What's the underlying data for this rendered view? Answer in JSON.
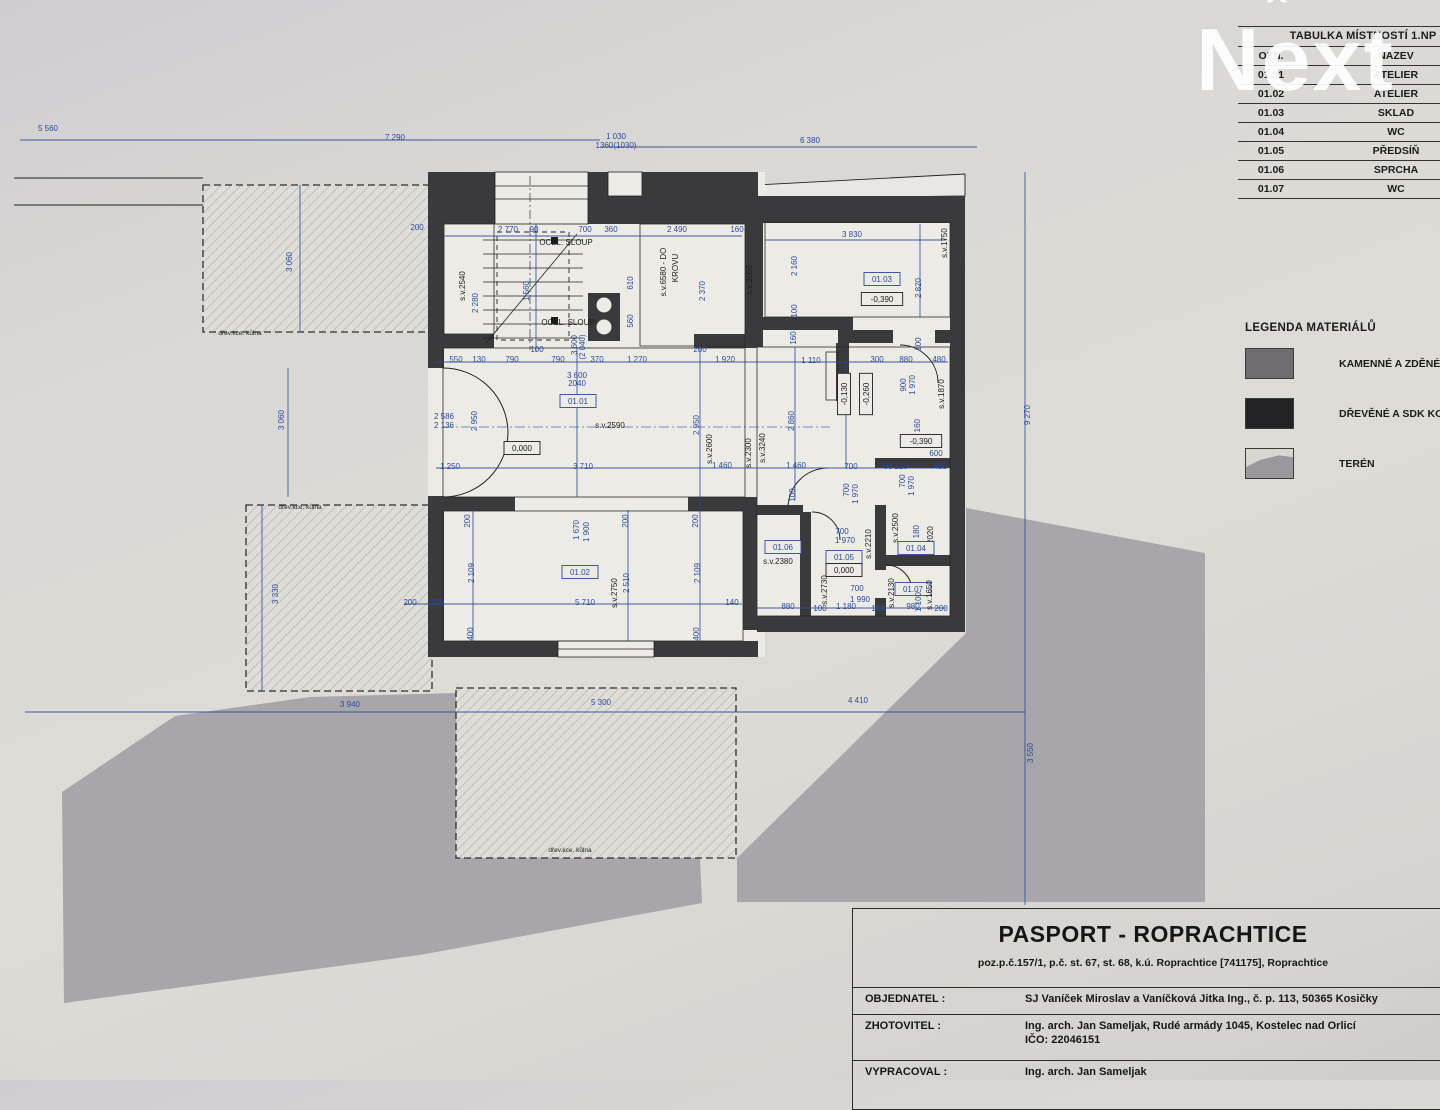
{
  "watermark": {
    "text_n": "N",
    "text_e": "e",
    "caret": "ˆ",
    "text_xt": "xt"
  },
  "colors": {
    "paper": "#dcdad5",
    "terrain_gray": "#a8a6aa",
    "wall_dark": "#3a3a3d",
    "dimension_blue": "#2b4a9b",
    "line_black": "#1f1f1f",
    "watermark_white": "#ffffff"
  },
  "room_table": {
    "title": "TABULKA MÍSTNOSTÍ 1.NP",
    "col_ozn": "OZN.",
    "col_nazev": "NÁZEV",
    "rows": [
      {
        "ozn": "01.01",
        "nazev": "ATELIER"
      },
      {
        "ozn": "01.02",
        "nazev": "ATELIER"
      },
      {
        "ozn": "01.03",
        "nazev": "SKLAD"
      },
      {
        "ozn": "01.04",
        "nazev": "WC"
      },
      {
        "ozn": "01.05",
        "nazev": "PŘEDSÍŇ"
      },
      {
        "ozn": "01.06",
        "nazev": "SPRCHA"
      },
      {
        "ozn": "01.07",
        "nazev": "WC"
      }
    ]
  },
  "legend": {
    "title": "LEGENDA MATERIÁLŮ",
    "items": [
      {
        "label": "KAMENNÉ A ZDĚNÉ K",
        "swatch": "masonry"
      },
      {
        "label": "DŘEVĚNÉ A SDK KO",
        "swatch": "wood"
      },
      {
        "label": "TERÉN",
        "swatch": "terrain"
      }
    ]
  },
  "title_block": {
    "title": "PASPORT - ROPRACHTICE",
    "subtitle": "poz.p.č.157/1, p.č. st. 67, st. 68, k.ú. Roprachtice [741175], Roprachtice",
    "fields": [
      {
        "label": "OBJEDNATEL :",
        "value": "SJ Vaníček Miroslav a Vaníčková Jitka Ing., č. p. 113, 50365 Kosičky",
        "value2": ""
      },
      {
        "label": "ZHOTOVITEL :",
        "value": "Ing. arch. Jan Sameljak, Rudé armády 1045, Kostelec nad Orlicí",
        "value2": "IČO: 22046151"
      },
      {
        "label": "VYPRACOVAL :",
        "value": "Ing. arch. Jan Sameljak",
        "value2": ""
      }
    ]
  },
  "plan": {
    "labels": [
      {
        "t": "5 560",
        "x": 48,
        "y": 131
      },
      {
        "t": "7 290",
        "x": 395,
        "y": 140
      },
      {
        "t": "1 030",
        "x": 616,
        "y": 139
      },
      {
        "t": "1360(1030)",
        "x": 616,
        "y": 148
      },
      {
        "t": "6 380",
        "x": 810,
        "y": 143
      },
      {
        "t": "9 270",
        "x": 1030,
        "y": 415,
        "r": -90
      },
      {
        "t": "3 550",
        "x": 1033,
        "y": 753,
        "r": -90
      },
      {
        "t": "3 940",
        "x": 350,
        "y": 707
      },
      {
        "t": "5 300",
        "x": 601,
        "y": 705
      },
      {
        "t": "4 410",
        "x": 858,
        "y": 703
      },
      {
        "t": "3 060",
        "x": 292,
        "y": 262,
        "r": -90
      },
      {
        "t": "3 060",
        "x": 284,
        "y": 420,
        "r": -90
      },
      {
        "t": "3 330",
        "x": 278,
        "y": 594,
        "r": -90
      },
      {
        "t": "200",
        "x": 417,
        "y": 230
      },
      {
        "t": "2 770",
        "x": 508,
        "y": 232
      },
      {
        "t": "90",
        "x": 534,
        "y": 232
      },
      {
        "t": "700",
        "x": 585,
        "y": 232
      },
      {
        "t": "360",
        "x": 611,
        "y": 232
      },
      {
        "t": "2 490",
        "x": 677,
        "y": 232
      },
      {
        "t": "160",
        "x": 737,
        "y": 232
      },
      {
        "t": "3 830",
        "x": 852,
        "y": 237
      },
      {
        "t": "s.v.1750",
        "x": 947,
        "y": 243,
        "r": -90,
        "c": "k"
      },
      {
        "t": "s.v.2540",
        "x": 465,
        "y": 286,
        "r": -90,
        "c": "k"
      },
      {
        "t": "2 280",
        "x": 478,
        "y": 303,
        "r": -90
      },
      {
        "t": "1 560",
        "x": 529,
        "y": 291,
        "r": -90
      },
      {
        "t": "610",
        "x": 633,
        "y": 283,
        "r": -90
      },
      {
        "t": "560",
        "x": 633,
        "y": 321,
        "r": -90
      },
      {
        "t": "s.v.6580 - DO",
        "x": 666,
        "y": 272,
        "r": -90,
        "c": "k"
      },
      {
        "t": "KROVU",
        "x": 678,
        "y": 268,
        "r": -90,
        "c": "k"
      },
      {
        "t": "2 370",
        "x": 705,
        "y": 291,
        "r": -90
      },
      {
        "t": "s.v.3060",
        "x": 752,
        "y": 280,
        "r": -90,
        "c": "k"
      },
      {
        "t": "2 160",
        "x": 797,
        "y": 266,
        "r": -90
      },
      {
        "t": "01.03",
        "x": 882,
        "y": 282,
        "bx": 1
      },
      {
        "t": "-0,390",
        "x": 882,
        "y": 302,
        "bx": 1,
        "c": "k"
      },
      {
        "t": "2 820",
        "x": 921,
        "y": 288,
        "r": -90
      },
      {
        "t": "100",
        "x": 797,
        "y": 311,
        "r": -90
      },
      {
        "t": "100",
        "x": 921,
        "y": 344,
        "r": -90
      },
      {
        "t": "OCEL. SLOUP",
        "x": 566,
        "y": 245,
        "c": "k"
      },
      {
        "t": "OCEL. SLOUP",
        "x": 568,
        "y": 325,
        "c": "k"
      },
      {
        "t": "100",
        "x": 537,
        "y": 352
      },
      {
        "t": "3 600",
        "x": 577,
        "y": 345,
        "r": -90
      },
      {
        "t": "(2 040)",
        "x": 585,
        "y": 347,
        "r": -90
      },
      {
        "t": "550",
        "x": 456,
        "y": 362
      },
      {
        "t": "130",
        "x": 479,
        "y": 362
      },
      {
        "t": "790",
        "x": 512,
        "y": 362
      },
      {
        "t": "790",
        "x": 558,
        "y": 362
      },
      {
        "t": "370",
        "x": 597,
        "y": 362
      },
      {
        "t": "1 270",
        "x": 637,
        "y": 362
      },
      {
        "t": "1 920",
        "x": 725,
        "y": 362
      },
      {
        "t": "1 110",
        "x": 811,
        "y": 363
      },
      {
        "t": "300",
        "x": 877,
        "y": 362
      },
      {
        "t": "880",
        "x": 906,
        "y": 362
      },
      {
        "t": "480",
        "x": 939,
        "y": 362
      },
      {
        "t": "200",
        "x": 700,
        "y": 352
      },
      {
        "t": "160",
        "x": 796,
        "y": 338,
        "r": -90
      },
      {
        "t": "3 600",
        "x": 577,
        "y": 378
      },
      {
        "t": "2040",
        "x": 577,
        "y": 386
      },
      {
        "t": "900",
        "x": 906,
        "y": 385,
        "r": -90
      },
      {
        "t": "1 970",
        "x": 915,
        "y": 385,
        "r": -90
      },
      {
        "t": "s.v.1870",
        "x": 944,
        "y": 394,
        "r": -90,
        "c": "k"
      },
      {
        "t": "-0,130",
        "x": 847,
        "y": 394,
        "r": -90,
        "bx": 1,
        "c": "k"
      },
      {
        "t": "-0,260",
        "x": 869,
        "y": 394,
        "r": -90,
        "bx": 1,
        "c": "k"
      },
      {
        "t": "01.01",
        "x": 578,
        "y": 404,
        "bx": 1
      },
      {
        "t": "s.v.2590",
        "x": 610,
        "y": 428,
        "c": "k"
      },
      {
        "t": "0,000",
        "x": 522,
        "y": 451,
        "bx": 1,
        "c": "k"
      },
      {
        "t": "2 586",
        "x": 444,
        "y": 419
      },
      {
        "t": "2 136",
        "x": 444,
        "y": 428
      },
      {
        "t": "2 950",
        "x": 477,
        "y": 421,
        "r": -90
      },
      {
        "t": "2 950",
        "x": 699,
        "y": 425,
        "r": -90
      },
      {
        "t": "2 860",
        "x": 794,
        "y": 421,
        "r": -90
      },
      {
        "t": "s.v.2600",
        "x": 712,
        "y": 449,
        "r": -90,
        "c": "k"
      },
      {
        "t": "s.v.2300",
        "x": 751,
        "y": 453,
        "r": -90,
        "c": "k"
      },
      {
        "t": "s.v.3240",
        "x": 765,
        "y": 448,
        "r": -90,
        "c": "k"
      },
      {
        "t": "2 160",
        "x": 920,
        "y": 429,
        "r": -90
      },
      {
        "t": "-0,390",
        "x": 921,
        "y": 444,
        "bx": 1,
        "c": "k"
      },
      {
        "t": "600",
        "x": 936,
        "y": 456
      },
      {
        "t": "1 250",
        "x": 450,
        "y": 469
      },
      {
        "t": "3 710",
        "x": 583,
        "y": 469
      },
      {
        "t": "1 460",
        "x": 722,
        "y": 468
      },
      {
        "t": "1 460",
        "x": 796,
        "y": 468
      },
      {
        "t": "700",
        "x": 851,
        "y": 469
      },
      {
        "t": "90",
        "x": 888,
        "y": 469
      },
      {
        "t": "210",
        "x": 901,
        "y": 469
      },
      {
        "t": "480",
        "x": 940,
        "y": 469
      },
      {
        "t": "700",
        "x": 905,
        "y": 481,
        "r": -90
      },
      {
        "t": "1 970",
        "x": 914,
        "y": 486,
        "r": -90
      },
      {
        "t": "100",
        "x": 795,
        "y": 495,
        "r": -90
      },
      {
        "t": "700",
        "x": 849,
        "y": 490,
        "r": -90
      },
      {
        "t": "1 970",
        "x": 858,
        "y": 494,
        "r": -90
      },
      {
        "t": "01.06",
        "x": 783,
        "y": 550,
        "bx": 1
      },
      {
        "t": "s.v.2380",
        "x": 778,
        "y": 564,
        "c": "k"
      },
      {
        "t": "700",
        "x": 842,
        "y": 534
      },
      {
        "t": "1 970",
        "x": 845,
        "y": 543
      },
      {
        "t": "01.05",
        "x": 844,
        "y": 560,
        "bx": 1
      },
      {
        "t": "0,000",
        "x": 844,
        "y": 573,
        "bx": 1,
        "c": "k"
      },
      {
        "t": "s.v.2210",
        "x": 871,
        "y": 544,
        "r": -90,
        "c": "k"
      },
      {
        "t": "s.v.2500",
        "x": 898,
        "y": 528,
        "r": -90,
        "c": "k"
      },
      {
        "t": "1 180",
        "x": 919,
        "y": 535,
        "r": -90
      },
      {
        "t": "s.v.2020",
        "x": 933,
        "y": 541,
        "r": -90,
        "c": "k"
      },
      {
        "t": "01.04",
        "x": 916,
        "y": 551,
        "bx": 1
      },
      {
        "t": "s.v.2730",
        "x": 827,
        "y": 590,
        "r": -90,
        "c": "k"
      },
      {
        "t": "700",
        "x": 857,
        "y": 591
      },
      {
        "t": "1 990",
        "x": 860,
        "y": 602
      },
      {
        "t": "s.v.2130",
        "x": 894,
        "y": 593,
        "r": -90,
        "c": "k"
      },
      {
        "t": "01.07",
        "x": 913,
        "y": 592,
        "bx": 1
      },
      {
        "t": "s.v.1650",
        "x": 932,
        "y": 595,
        "r": -90,
        "c": "k"
      },
      {
        "t": "880",
        "x": 788,
        "y": 609
      },
      {
        "t": "100",
        "x": 820,
        "y": 611
      },
      {
        "t": "1 180",
        "x": 846,
        "y": 609
      },
      {
        "t": "100",
        "x": 878,
        "y": 611
      },
      {
        "t": "980",
        "x": 913,
        "y": 609
      },
      {
        "t": "1 100",
        "x": 921,
        "y": 602,
        "r": -90
      },
      {
        "t": "200",
        "x": 941,
        "y": 611
      },
      {
        "t": "200",
        "x": 470,
        "y": 521,
        "r": -90
      },
      {
        "t": "1 670",
        "x": 579,
        "y": 530,
        "r": -90
      },
      {
        "t": "1 900",
        "x": 589,
        "y": 532,
        "r": -90
      },
      {
        "t": "200",
        "x": 628,
        "y": 521,
        "r": -90
      },
      {
        "t": "200",
        "x": 698,
        "y": 521,
        "r": -90
      },
      {
        "t": "2 109",
        "x": 474,
        "y": 573,
        "r": -90
      },
      {
        "t": "01.02",
        "x": 580,
        "y": 575,
        "bx": 1
      },
      {
        "t": "2 510",
        "x": 629,
        "y": 583,
        "r": -90
      },
      {
        "t": "s.v.2750",
        "x": 617,
        "y": 593,
        "r": -90,
        "c": "k"
      },
      {
        "t": "2 109",
        "x": 700,
        "y": 573,
        "r": -90
      },
      {
        "t": "200",
        "x": 410,
        "y": 605
      },
      {
        "t": "150",
        "x": 437,
        "y": 605
      },
      {
        "t": "5 710",
        "x": 585,
        "y": 605
      },
      {
        "t": "140",
        "x": 732,
        "y": 605
      },
      {
        "t": "400",
        "x": 473,
        "y": 634,
        "r": -90
      },
      {
        "t": "400",
        "x": 699,
        "y": 634,
        "r": -90
      },
      {
        "t": "dřev.kce. kůlna",
        "x": 240,
        "y": 335,
        "c": "k",
        "s": 6.5
      },
      {
        "t": "dřev.kce. kůlna",
        "x": 300,
        "y": 509,
        "c": "k",
        "s": 6.5
      },
      {
        "t": "dřev.kce. kůlna",
        "x": 570,
        "y": 852,
        "c": "k",
        "s": 6.5
      }
    ]
  }
}
